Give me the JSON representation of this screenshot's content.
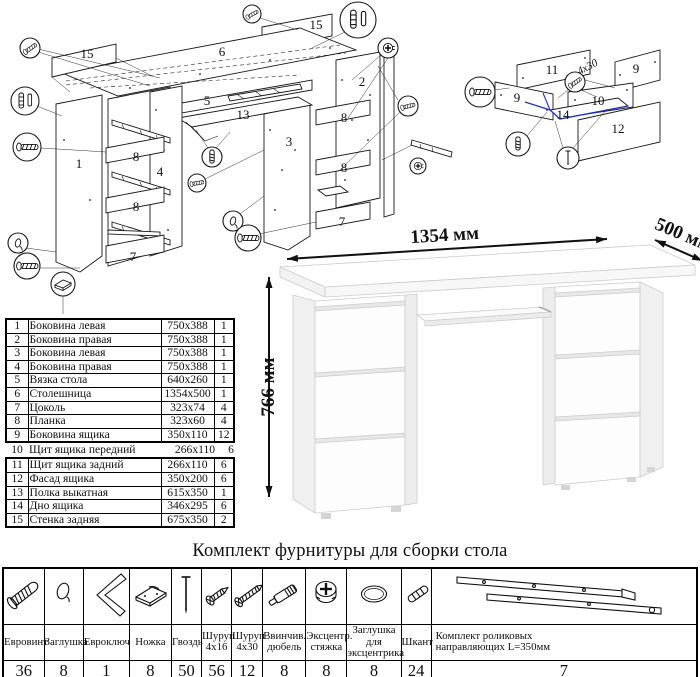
{
  "diagram_main": {
    "labels": [
      "15",
      "6",
      "15",
      "2",
      "1",
      "4",
      "3",
      "5",
      "13",
      "8",
      "8",
      "8",
      "8",
      "7",
      "7"
    ]
  },
  "diagram_drawer": {
    "labels": [
      "11",
      "9",
      "9",
      "10",
      "14",
      "12"
    ],
    "screw_note": "4x30"
  },
  "parts_table": {
    "rows": [
      {
        "num": "1",
        "name": "Боковина левая",
        "size": "750x388",
        "qty": "1"
      },
      {
        "num": "2",
        "name": "Боковина правая",
        "size": "750x388",
        "qty": "1"
      },
      {
        "num": "3",
        "name": "Боковина левая",
        "size": "750x388",
        "qty": "1"
      },
      {
        "num": "4",
        "name": "Боковина правая",
        "size": "750x388",
        "qty": "1"
      },
      {
        "num": "5",
        "name": "Вязка стола",
        "size": "640x260",
        "qty": "1"
      },
      {
        "num": "6",
        "name": "Столешница",
        "size": "1354x500",
        "qty": "1"
      },
      {
        "num": "7",
        "name": "Цоколь",
        "size": "323x74",
        "qty": "4"
      },
      {
        "num": "8",
        "name": "Планка",
        "size": "323x60",
        "qty": "4"
      },
      {
        "num": "9",
        "name": "Боковина ящика",
        "size": "350x110",
        "qty": "12"
      },
      {
        "num": "10",
        "name": "Щит ящика передний",
        "size": "266x110",
        "qty": "6"
      },
      {
        "num": "11",
        "name": "Щит ящика задний",
        "size": "266x110",
        "qty": "6"
      },
      {
        "num": "12",
        "name": "Фасад ящика",
        "size": "350x200",
        "qty": "6"
      },
      {
        "num": "13",
        "name": "Полка выкатная",
        "size": "615x350",
        "qty": "1"
      },
      {
        "num": "14",
        "name": "Дно ящика",
        "size": "346x295",
        "qty": "6"
      },
      {
        "num": "15",
        "name": "Стенка задняя",
        "size": "675x350",
        "qty": "2"
      }
    ]
  },
  "desk": {
    "width": "1354 мм",
    "depth": "500 мм",
    "height": "766 мм"
  },
  "hardware": {
    "title": "Комплект фурнитуры для сборки стола",
    "items": [
      {
        "name": "Евровинт",
        "qty": "36",
        "icon": "euro-screw-icon"
      },
      {
        "name": "Заглушка",
        "qty": "8",
        "icon": "cap-icon"
      },
      {
        "name": "Евроключ",
        "qty": "1",
        "icon": "hex-key-icon"
      },
      {
        "name": "Ножка",
        "qty": "8",
        "icon": "foot-icon"
      },
      {
        "name": "Гвоздь",
        "qty": "50",
        "icon": "nail-icon"
      },
      {
        "name": "Шуруп\n4x16",
        "qty": "56",
        "icon": "screw-short-icon"
      },
      {
        "name": "Шуруп\n4x30",
        "qty": "12",
        "icon": "screw-long-icon"
      },
      {
        "name": "Ввинчив.\nдюбель",
        "qty": "8",
        "icon": "dowel-screw-icon"
      },
      {
        "name": "Эксцентр.\nстяжка",
        "qty": "8",
        "icon": "cam-lock-icon"
      },
      {
        "name": "Заглушка для\nэксцентрика",
        "qty": "8",
        "icon": "cam-cap-icon"
      },
      {
        "name": "Шкант",
        "qty": "24",
        "icon": "wood-dowel-icon"
      },
      {
        "name": "Комплект роликовых\nнаправляющих L=350мм",
        "qty": "7",
        "icon": "drawer-slides-icon"
      }
    ]
  },
  "colors": {
    "ink": "#1a1a1a",
    "accent_blue": "#2233cc",
    "desk_edge": "#cccccc"
  }
}
